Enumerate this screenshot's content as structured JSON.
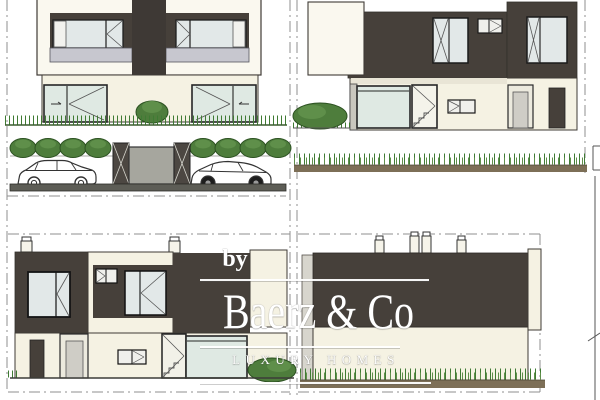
{
  "watermark": {
    "by": "by",
    "brand": "Baerz & Co",
    "tagline": "LUXURY HOMES"
  },
  "palette": {
    "dark": "#46403a",
    "column": "#3e3935",
    "cream": "#f5f2e3",
    "frame": "#faf8ef",
    "sill": "#e9e5d6",
    "glass": "#e2e8e8",
    "glass2": "#dfe9e3",
    "railing": "#c7c7cf",
    "doorgray": "#cfcdc6",
    "doorlite": "#eceade",
    "gate": "#a6a69e",
    "pillar": "#4c4742",
    "road": "#5d5d56",
    "earth": "#7d6f57",
    "grass": "#3f7b33",
    "grassline": "#3a5c2e",
    "bush": "#4e7d3c",
    "bushlite": "#5f8f4a",
    "outline": "#3f3b36",
    "dash": "#8f8f8f",
    "dim": "#555555",
    "white": "#ffffff"
  }
}
